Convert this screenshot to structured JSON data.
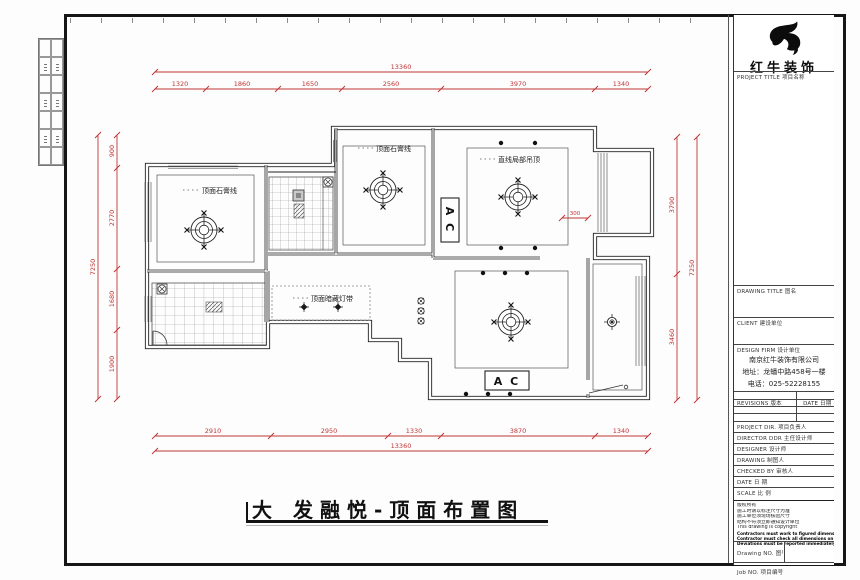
{
  "sheet": {
    "bottom_title": "大 发融悦-顶面布置图"
  },
  "logo": {
    "name": "红牛装饰"
  },
  "titleblock": {
    "project_title_label": "PROJECT TITLE 项目名称",
    "drawing_title_label": "DRAWING TITLE 图名",
    "client_label": "CLIENT 建设单位",
    "design_firm_label": "DESIGN FIRM 设计单位",
    "firm_name": "南京红牛装饰有限公司",
    "firm_address": "地址：龙蟠中路458号一楼",
    "firm_phone": "电话：025-52228155",
    "revisions_label": "REVISIONS 版本",
    "revisions_date_label": "DATE 日期",
    "project_dir_label": "PROJECT DIR. 项目负责人",
    "director_label": "DIRECTOR DDR 主任设计师",
    "designer_label": "DESIGNER 设计师",
    "drafter_label": "DRAWING 制图人",
    "checked_label": "CHECKED BY 审核人",
    "date_label": "DATE 日 期",
    "scale_label": "SCALE 比 例",
    "notes": [
      "版权所有",
      "施工时请以标注尺寸为准",
      "施工单位须现场核验尺寸",
      "结构不符须立即通知设计单位",
      "This drawing is copyright",
      "Contractors must work to figured dimensions only",
      "Contractor must check all dimensions on site",
      "Deviations must be reported immediately to architects"
    ],
    "drawing_no_label": "Drawing NO. 图号",
    "job_no_label": "Job NO. 项目编号"
  },
  "plan": {
    "room_labels": {
      "gypsum_left": "顶面石膏线",
      "gypsum_mid": "顶面石膏线",
      "partial_drop_ceiling": "直线局部吊顶",
      "concealed_light_strip": "顶面暗藏灯带",
      "ac_vertical": "A C",
      "ac_horizontal": "A C"
    },
    "dims": {
      "top_total": "13360",
      "top": [
        "1320",
        "1860",
        "1650",
        "2560",
        "3970",
        "1340"
      ],
      "bottom": [
        "2910",
        "2950",
        "1330",
        "3870",
        "1340"
      ],
      "bottom_total": "13360",
      "left": [
        "900",
        "2770",
        "1680",
        "1900"
      ],
      "left_total": "7250",
      "right": [
        "3790",
        "3460"
      ],
      "right_total": "7250",
      "small": "300"
    }
  }
}
